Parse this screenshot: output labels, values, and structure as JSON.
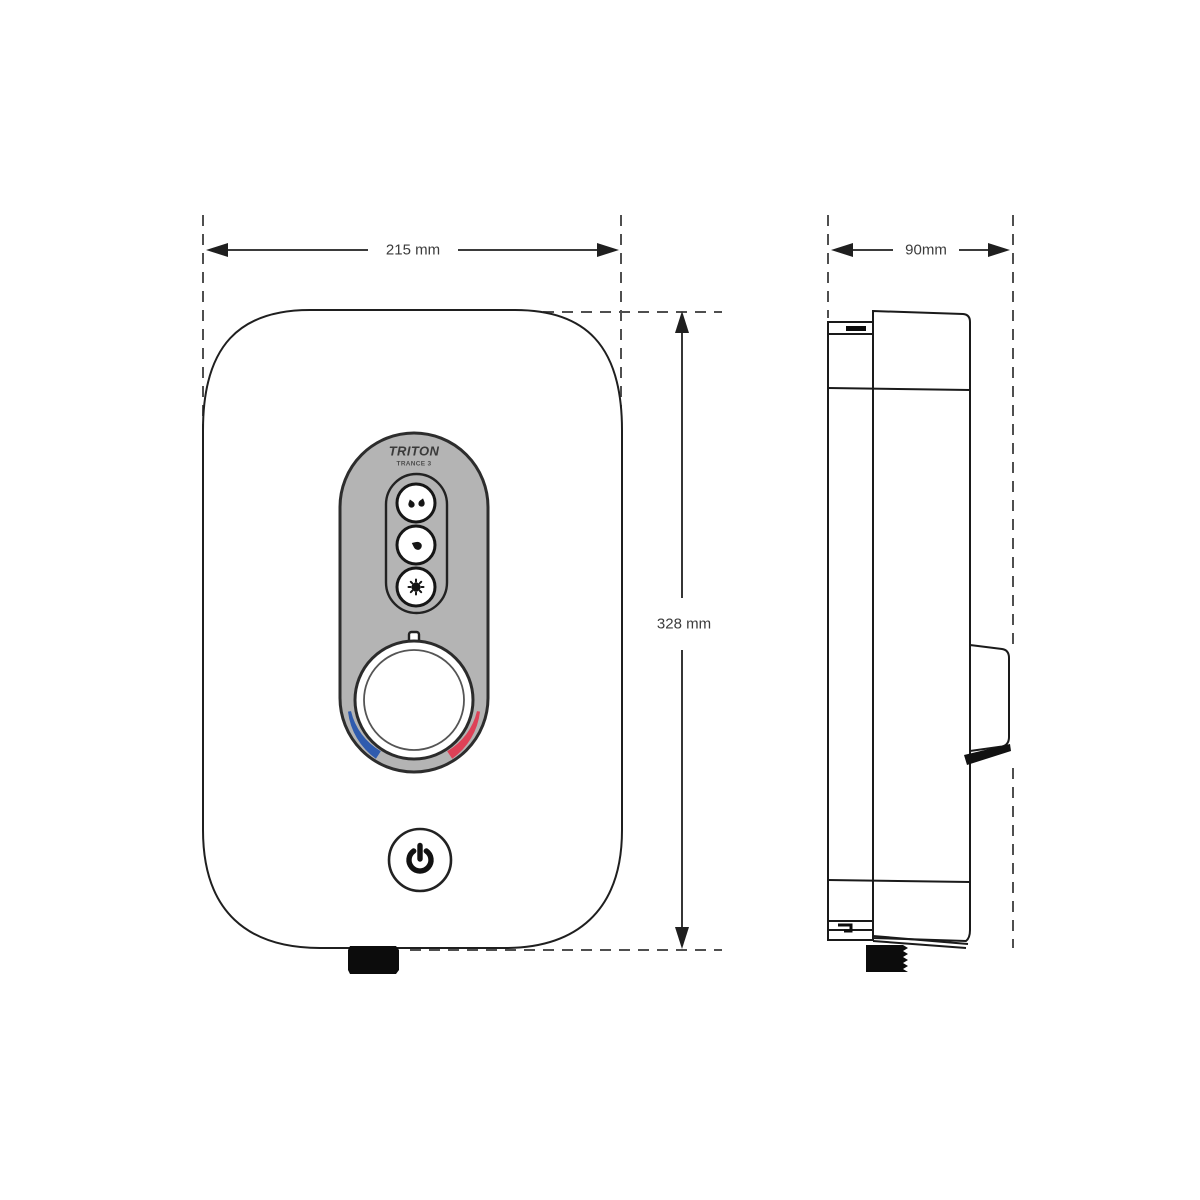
{
  "diagram": {
    "type": "technical-dimension-drawing",
    "subject": "electric shower unit, front and side elevation",
    "brand": "TRITON",
    "model": "TRANCE 3",
    "dimensions": {
      "front_width_label": "215 mm",
      "front_height_label": "328 mm",
      "side_depth_label": "90mm"
    },
    "colors": {
      "cold": "#2f5bae",
      "hot": "#de4157",
      "panel": "#b4b4b4",
      "line": "#1f1f1f",
      "dash": "#4f4f4f",
      "text": "#3b3b3b"
    },
    "icons": {
      "spray_high": "two-drops-icon",
      "spray_medium": "one-drop-icon",
      "spray_eco": "starburst-dot-icon",
      "power": "power-symbol-icon",
      "dial_pointer": "index-tick"
    }
  }
}
